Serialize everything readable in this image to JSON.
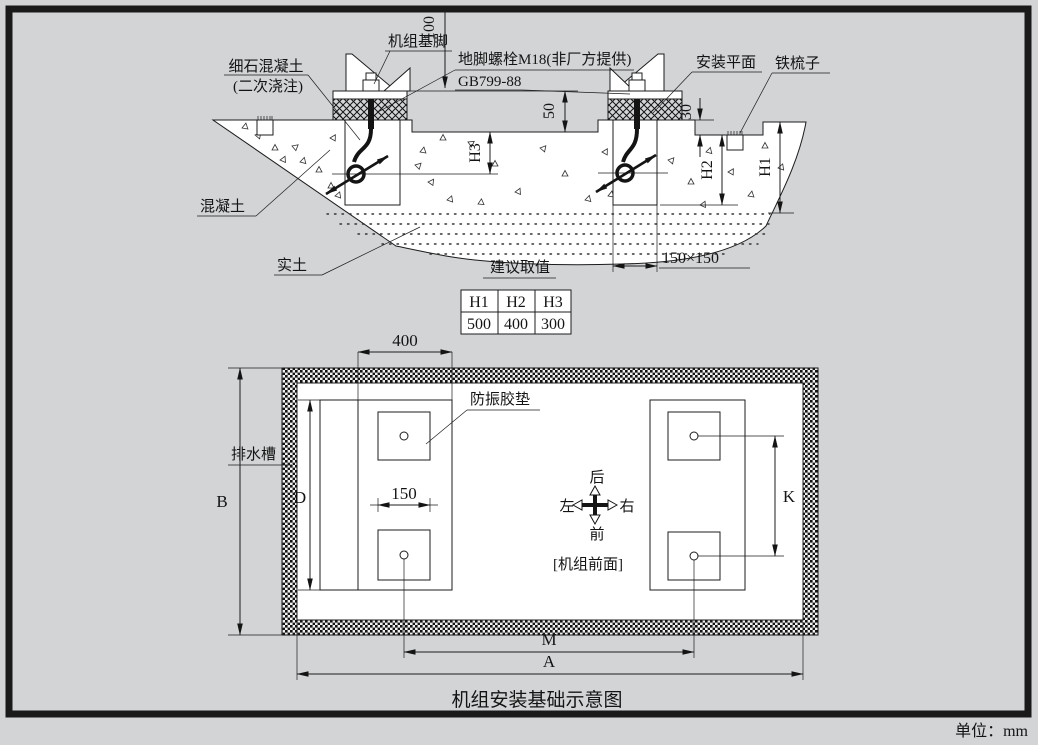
{
  "frame": {
    "unit_note": "单位：mm"
  },
  "section": {
    "labels": {
      "machine_foot": "机组基脚",
      "fine_concrete_line1": "细石混凝土",
      "fine_concrete_line2": "(二次浇注)",
      "anchor_bolt": "地脚螺栓M18(非厂方提供)",
      "bolt_standard": "GB799-88",
      "mounting_plane": "安装平面",
      "iron_comb": "铁梳子",
      "concrete": "混凝土",
      "solid_soil": "实土"
    },
    "dims": {
      "d100": "100",
      "d50": "50",
      "d30": "30",
      "h3": "H3",
      "h2": "H2",
      "h1": "H1",
      "pocket": "150×150"
    }
  },
  "table": {
    "title": "建议取值",
    "headers": [
      "H1",
      "H2",
      "H3"
    ],
    "values": [
      "500",
      "400",
      "300"
    ]
  },
  "plan": {
    "labels": {
      "vibration_pad": "防振胶垫",
      "drain_channel": "排水槽",
      "unit_front": "[机组前面]"
    },
    "dims": {
      "d400": "400",
      "d150": "150",
      "B": "B",
      "D": "D",
      "K": "K",
      "M": "M",
      "A": "A"
    },
    "compass": {
      "back": "后",
      "front": "前",
      "left": "左",
      "right": "右"
    }
  },
  "caption": "机组安装基础示意图"
}
